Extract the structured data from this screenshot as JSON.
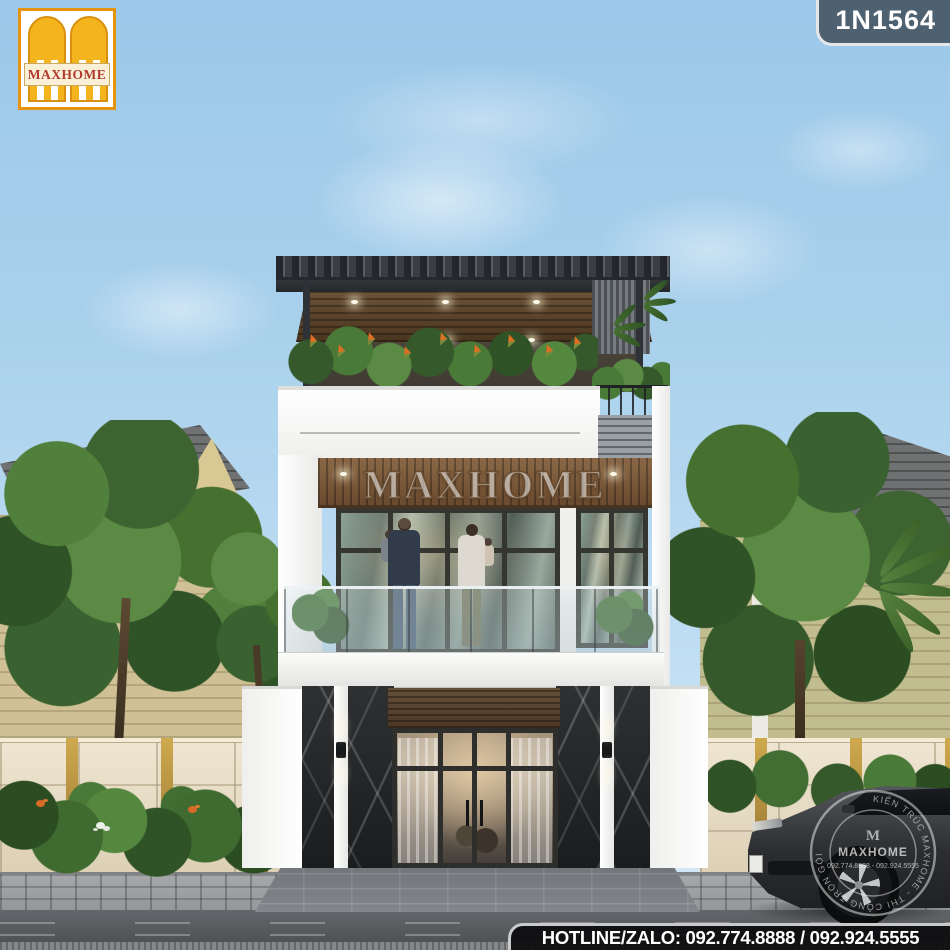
{
  "branding": {
    "logo": {
      "name": "MAXHOME",
      "monogram": "M"
    },
    "model_code": "1N1564",
    "facade_watermark": "MAXHOME",
    "hotline": "HOTLINE/ZALO: 092.774.8888 / 092.924.5555",
    "stamp": {
      "ring_text": "KIẾN TRÚC MAXHOME - THI CÔNG TRỌN GÓI",
      "name": "MAXHOME",
      "phones": "092.774.8888 - 092.924.5555"
    }
  },
  "palette": {
    "sky_blue": "#a9d1ec",
    "logo_gold": "#f3b41d",
    "logo_border_orange": "#e6930e",
    "logo_text_red": "#b03a2e",
    "badge_bg": "#4e6170",
    "hotline_bar_bg": "#0e0e10",
    "hotline_text": "#ffffff",
    "pergola_dark": "#3a3e42",
    "wood_brown": "#7a5a3c",
    "marble_black": "#1f2123",
    "wall_white": "#f5f5f3",
    "fence_beige": "#e6dcc6",
    "fence_gold_strip": "#b08d3f",
    "foliage_green": "#4e7a3a",
    "glass_green": "#7d8f84",
    "road_gray": "#55585b",
    "neighbor_wall": "#cfc195",
    "neighbor_roof": "#6f7172",
    "neighbor_window_blue": "#3e6ea6",
    "car_gray": "#3c3f42"
  }
}
